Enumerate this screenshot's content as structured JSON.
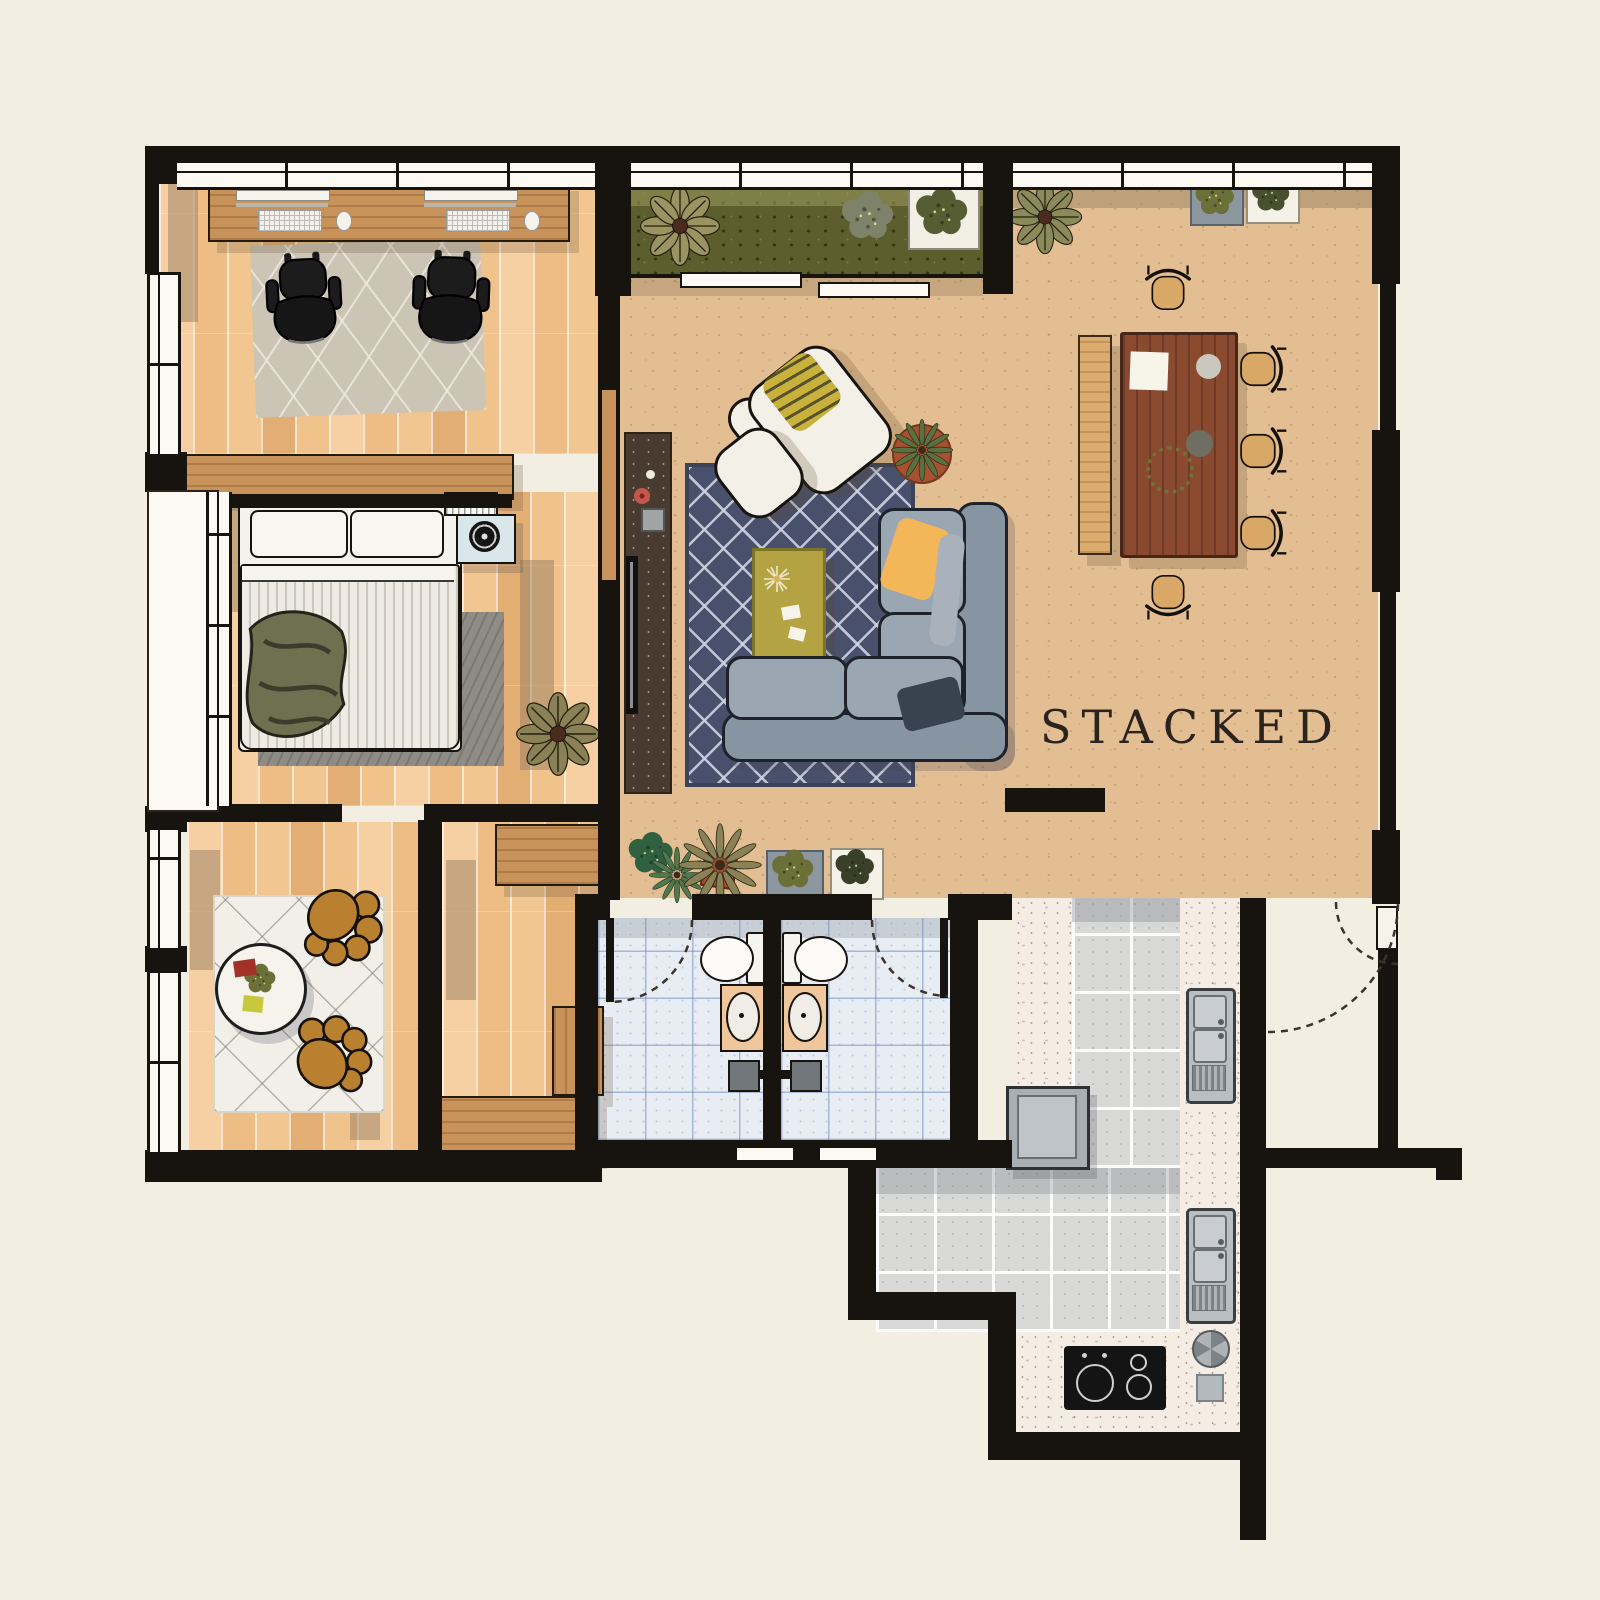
{
  "watermark": {
    "label": "STACKED"
  },
  "palette": {
    "background": "#F2EFE2",
    "wall": "#17130F",
    "wood_floor": "#F1C492",
    "living_floor": "#E3BE92",
    "planter_olive": "#5C5E2E",
    "wood_furniture": "#C8935A",
    "dining_table": "#8A4A30",
    "dining_chair": "#D9A766",
    "bench_wood": "#DCAB6E",
    "rug_navy": "#49506B",
    "rug_pattern": "#CED3E2",
    "coffee_table": "#B3A342",
    "sofa_back": "#8795A3",
    "sofa_seat": "#9AA7B3",
    "pillow_yellow": "#F3B75A",
    "pillow_navy": "#39424F",
    "white_furniture": "#F3F0E7",
    "armchair": "#B8802F",
    "study_rug": "#CCC4B4",
    "sitting_rug": "#F1EFE8",
    "bedroom_rug": "#8F8C86",
    "bed_throw": "#6F7050",
    "nightstand": "#D9E7EB",
    "tv_console": "#4A3B31",
    "bathroom_tile": "#E8ECF3",
    "bathroom_grid": "#6482B4",
    "vanity": "#F0C79C",
    "kitchen_tile": "#D8D8D6",
    "counter": "#F5EDE4",
    "appliance": "#B9BEC3",
    "cooktop": "#141414",
    "accent_red": "#A33226",
    "accent_chartreuse": "#C8C83E",
    "plant_olive": "#8A8A5A",
    "plant_green": "#4F7A50",
    "plant_dark": "#3A4028",
    "plant_gray": "#7D8268",
    "terracotta": "#A8502F",
    "door_arc": "#3A332C",
    "watermark_color": "#2B241E"
  }
}
